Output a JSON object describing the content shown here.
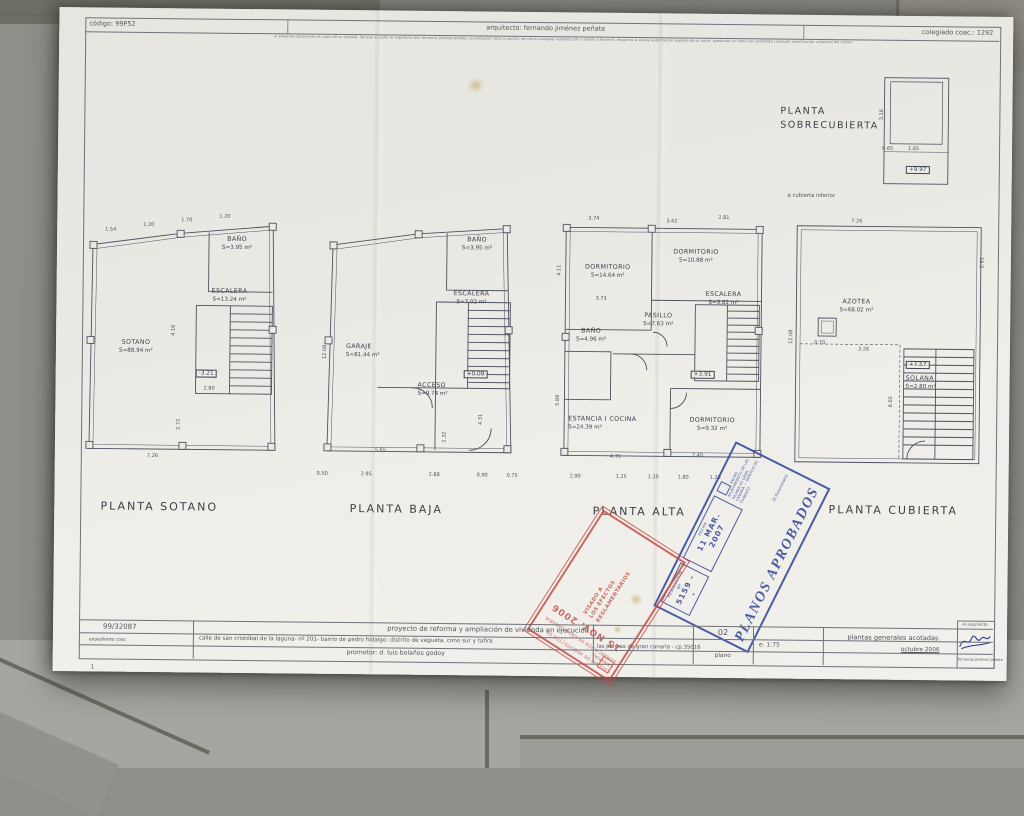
{
  "header": {
    "codigo": "código: 99P52",
    "arquitecto": "arquitecto: fernando jiménez peñate",
    "disclaimer": "el presente documento es copia de su original, del que es autor el arquitecto don fernando jiménez peñate, su utilización total o parcial, así como cualquier reproducción o cesión a terceros, requerirá la previa autorización expresa de su autor, quedando en todo caso prohibida cualquier modificación unilateral del mismo",
    "colegiado": "colegiado coac.: 1292"
  },
  "plans": [
    {
      "title": "PLANTA SOTANO",
      "rooms": [
        {
          "label": "SOTANO",
          "area": "S=88.94 m²"
        },
        {
          "label": "BAÑO",
          "area": "S=3.95 m²"
        },
        {
          "label": "ESCALERA",
          "area": "S=13.24 m²"
        }
      ],
      "level": "-3.21",
      "dims": [
        "1.54",
        "1.20",
        "1.70",
        "1.20",
        "4.16",
        "2.72",
        "7.26",
        "2.80"
      ]
    },
    {
      "title": "PLANTA BAJA",
      "rooms": [
        {
          "label": "GARAJE",
          "area": "S=81.44 m²"
        },
        {
          "label": "BAÑO",
          "area": "S=3.95 m²"
        },
        {
          "label": "ESCALERA",
          "area": "S=7.02 m²"
        },
        {
          "label": "ACCESO",
          "area": "S=9.74 m²"
        }
      ],
      "level": "+0.09",
      "dims": [
        "12.08",
        "5.65",
        "0.50",
        "2.95",
        "2.88",
        "0.90",
        "0.75",
        "4.31",
        "2.32"
      ]
    },
    {
      "title": "PLANTA ALTA",
      "rooms": [
        {
          "label": "DORMITORIO",
          "area": "S=14.64 m²"
        },
        {
          "label": "DORMITORIO",
          "area": "S=10.88 m²"
        },
        {
          "label": "ESCALERA",
          "area": "S=9.82 m²"
        },
        {
          "label": "PASILLO",
          "area": "S=7.63 m²"
        },
        {
          "label": "BAÑO",
          "area": "S=4.96 m²"
        },
        {
          "label": "ESTANCIA I COCINA",
          "area": "S=24.39 m²"
        },
        {
          "label": "DORMITORIO",
          "area": "S=9.32 m²"
        }
      ],
      "level": "+3.91",
      "dims": [
        "3.74",
        "3.42",
        "2.81",
        "4.11",
        "3.73",
        "5.89",
        "4.75",
        "2.40",
        "2.90",
        "1.25",
        "1.20",
        "1.80",
        "1.20"
      ]
    },
    {
      "title": "PLANTA CUBIERTA",
      "rooms": [
        {
          "label": "AZOTEA",
          "area": "S=68.02 m²"
        },
        {
          "label": "SOLANA",
          "area": "S=2.80 m²"
        }
      ],
      "level": "+7.57",
      "dims": [
        "7.26",
        "2.91",
        "12.08",
        "3.26",
        "0.70",
        "6.02"
      ]
    },
    {
      "title_line1": "PLANTA",
      "title_line2": "SOBRECUBIERTA",
      "note": "a cubierta inferior",
      "level": "+9.97",
      "dims": [
        "3.16",
        "1.65",
        "0.65"
      ]
    }
  ],
  "stamps": {
    "approval": {
      "title": "PLANOS APROBADOS",
      "resolucion_label": "RESOLUCIÓN Nº",
      "resolucion_num": "5159 - -",
      "fecha_label": "FECHA",
      "fecha": "11 MAR. 2007",
      "org": "EXCMO. AYUNTAMIENTO DE LAS PALMAS DE GRAN CANARIA — SERVICIO DE FOMENTO",
      "firmante": "El Funcionario"
    },
    "visado": {
      "org_line1": "COLEGIO DE ARQUITECTOS DE CANARIAS",
      "org_line2": "DEMARCACIÓN DE GRAN CANARIA",
      "fecha": "15 NOV. 2006",
      "texto": "VISADO A LOS EFECTOS REGLAMENTARIOS"
    }
  },
  "titleblock": {
    "expediente_num": "99/32087",
    "expediente_label": "expediente coac",
    "proyecto": "proyecto de reforma y ampliación de vivienda en ejecución",
    "direccion": "calle de san cristóbal de la laguna- nº 201- barrio de pedro hidalgo- distrito de vegueta, cono sur y tafira",
    "municipio": "las palmas de gran canaria - cp.35016",
    "promotor": "promotor: d. luis bolaños godoy",
    "plano_num": "02",
    "plano_label": "plano",
    "escala": "e. 1:75",
    "contenido": "plantas generales acotadas",
    "fecha": "octubre 2006",
    "firma_label": "el arquitecto",
    "firma_nombre": "fernando jiménez peñate",
    "page_mark": "1"
  }
}
